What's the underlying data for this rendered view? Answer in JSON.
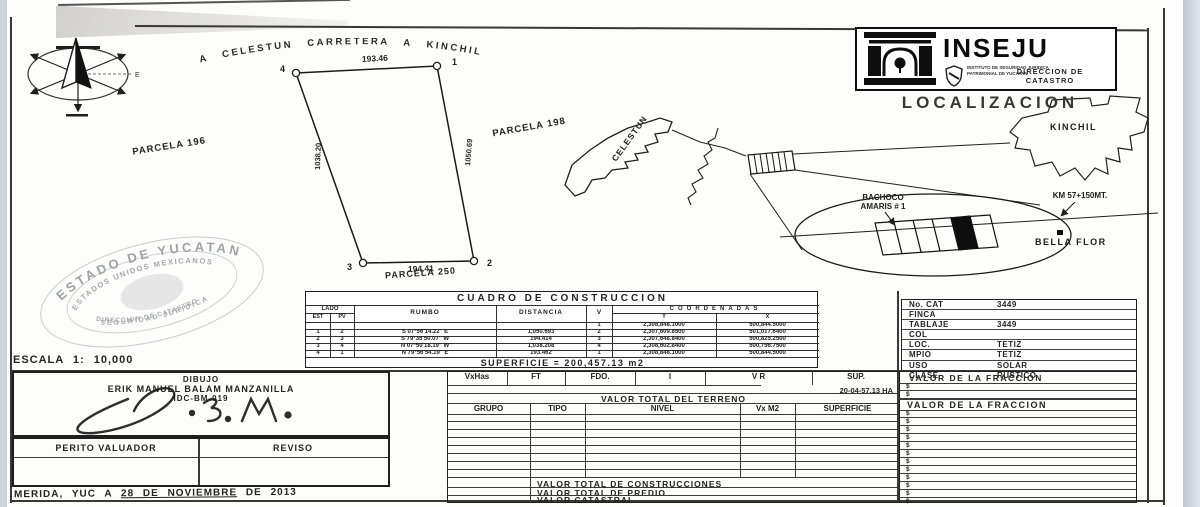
{
  "compass": {
    "east_label": "E"
  },
  "plano": {
    "road_label": "A CELESTUN CARRETERA A KINCHIL",
    "top_length": "193.46",
    "bottom_length": "194.41",
    "left_length": "1038.20",
    "right_length": "1050.69",
    "corner_1": "1",
    "corner_2": "2",
    "corner_3": "3",
    "corner_4": "4",
    "parcela_left": "PARCELA 196",
    "parcela_right": "PARCELA 198",
    "parcela_bottom": "PARCELA 250"
  },
  "logo": {
    "name": "INSEJU",
    "institute_line1": "INSTITUTO DE SEGURIDAD JURIDICA",
    "institute_line2": "PATRIMONIAL DE YUCATAN",
    "direccion_line1": "DIRECCION DE",
    "direccion_line2": "CATASTRO"
  },
  "localizacion": {
    "title": "LOCALIZACION",
    "kinchil": "KINCHIL",
    "celestun": "CELESTUN",
    "bachoco_line1": "BACHOCO",
    "bachoco_line2": "AMARIS # 1",
    "km": "KM 57+150MT.",
    "bella_flor": "BELLA FLOR"
  },
  "stamp": {
    "arc_top": "ESTADO DE YUCATAN",
    "arc_inner_top": "ESTADOS UNIDOS MEXICANOS",
    "arc_inner_bottom": "DIRECCION DE CATASTRO",
    "arc_bottom": "SEGURIDAD JURIDICA",
    "escala": "ESCALA  1: 10,000"
  },
  "cuadro": {
    "title": "CUADRO  DE  CONSTRUCCION",
    "h_lado": "LADO",
    "h_est": "EST",
    "h_pv": "PV",
    "h_rumbo": "RUMBO",
    "h_distancia": "DISTANCIA",
    "h_v": "V",
    "h_coordenadas": "COORDENADAS",
    "h_y": "Y",
    "h_x": "X",
    "rows": [
      {
        "est": "",
        "pv": "",
        "rumbo": "",
        "dist": "",
        "v": "1",
        "y": "2,308,848.1000",
        "x": "500,844.5000"
      },
      {
        "est": "1",
        "pv": "2",
        "rumbo": "S 07°56'14.22\" E",
        "dist": "1,050.693",
        "v": "2",
        "y": "2,307,609.8500",
        "x": "501,017.6400"
      },
      {
        "est": "2",
        "pv": "3",
        "rumbo": "S 79°35'50.07\" W",
        "dist": "194.414",
        "v": "3",
        "y": "2,307,648.8400",
        "x": "500,825.2500"
      },
      {
        "est": "3",
        "pv": "4",
        "rumbo": "N 07°50'18.19\" W",
        "dist": "1,038.208",
        "v": "4",
        "y": "2,308,602.8400",
        "x": "500,756.7500"
      },
      {
        "est": "4",
        "pv": "1",
        "rumbo": "N 79°56'54.19\" E",
        "dist": "193.462",
        "v": "1",
        "y": "2,308,848.1000",
        "x": "500,844.5000"
      }
    ],
    "superficie": "SUPERFICIE = 200,457.13 m2"
  },
  "ficha": {
    "rows": [
      {
        "label": "No. CAT",
        "value": "3449"
      },
      {
        "label": "FINCA",
        "value": ""
      },
      {
        "label": "TABLAJE",
        "value": "3449"
      },
      {
        "label": "COL",
        "value": ""
      },
      {
        "label": "LOC.",
        "value": "TETIZ"
      },
      {
        "label": "MPIO",
        "value": "TETIZ"
      },
      {
        "label": "USO",
        "value": "SOLAR"
      },
      {
        "label": "CLASE",
        "value": "RUSTICO"
      }
    ]
  },
  "firmas": {
    "dibujo_title": "DIBUJO",
    "dibujo_name": "ERIK MANUEL BALAM MANZANILLA",
    "dibujo_id": "IDC-BM-019",
    "perito": "PERITO VALUADOR",
    "reviso": "REVISO"
  },
  "fecha": {
    "pre": "MERIDA, YUC A",
    "mid": "28 DE NOVIEMBRE",
    "suf": "DE  2013"
  },
  "valuacion": {
    "top_headers": [
      "VxHas",
      "FT",
      "FDO.",
      "I",
      "V R",
      "SUP."
    ],
    "sup_value": "20-04-57.13 HA",
    "valor_terreno": "VALOR TOTAL DEL TERRENO",
    "grupo_headers": [
      "GRUPO",
      "TIPO",
      "NIVEL",
      "Vx M2",
      "SUPERFICIE"
    ],
    "valor_construcciones": "VALOR TOTAL DE CONSTRUCCIONES",
    "valor_predio": "VALOR TOTAL DE PREDIO",
    "valor_catastral": "VALOR CATASTRAL",
    "fraccion_title": "VALOR DE LA FRACCION",
    "dollar": "$"
  }
}
